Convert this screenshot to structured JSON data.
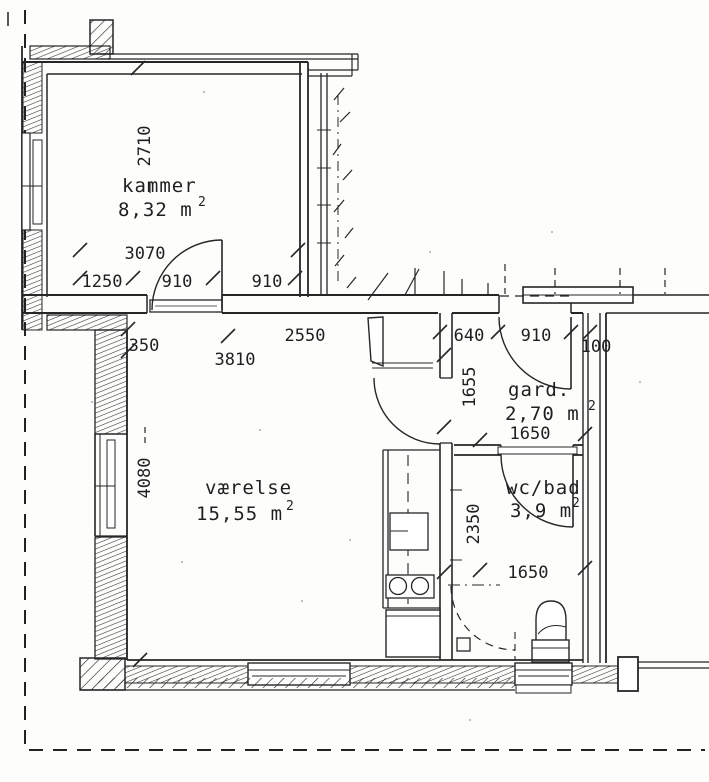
{
  "rooms": {
    "kammer": {
      "name": "kammer",
      "area": "8,32 m",
      "area_exp": "2"
    },
    "vaerelse": {
      "name": "værelse",
      "area": "15,55 m",
      "area_exp": "2"
    },
    "garderobe": {
      "name": "gard.",
      "area": "2,70 m",
      "area_exp": "2"
    },
    "wc_bad": {
      "name": "wc/bad",
      "area": "3,9 m",
      "area_exp": "2"
    }
  },
  "dims": {
    "kammer_depth": "2710",
    "kammer_width_total": "3070",
    "kammer_left": "1250",
    "kammer_door": "910",
    "kammer_right": "910",
    "offset_350": "350",
    "span_2550": "2550",
    "vaerelse_width": "3810",
    "entry_left": "640",
    "entry_door": "910",
    "wall_100": "100",
    "hall_1655": "1655",
    "gard_width": "1650",
    "vaerelse_depth": "4080",
    "bath_depth": "2350",
    "bath_width": "1650"
  }
}
